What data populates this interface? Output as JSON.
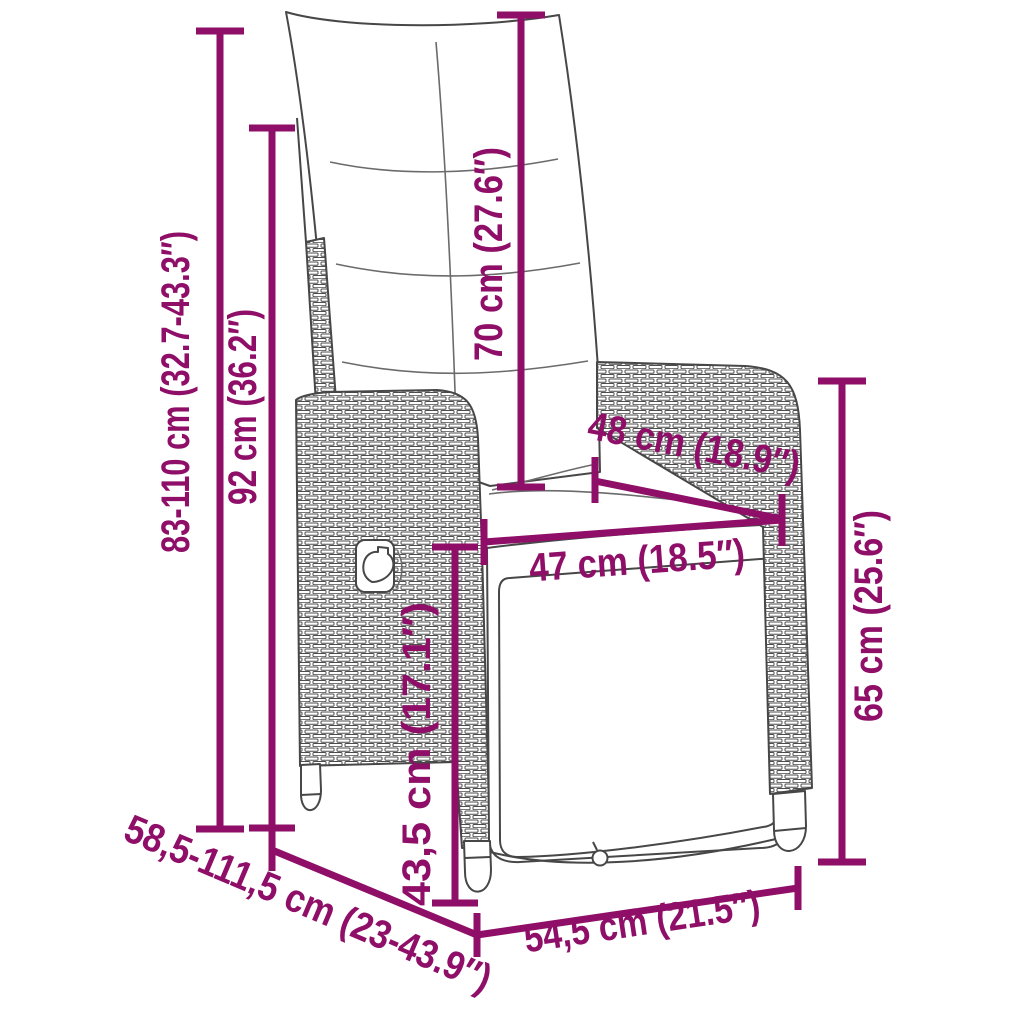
{
  "diagram": {
    "subject": "reclining garden chair with cushions - dimension drawing",
    "accent_color": "#8e0e68",
    "outline_color": "#474747",
    "units": [
      "cm",
      "inch"
    ],
    "dimensions": [
      {
        "id": "overall-height",
        "label": "83-110 cm (32.7-43.3″)",
        "orientation": "vertical"
      },
      {
        "id": "backrest-height",
        "label": "92 cm (36.2″)",
        "orientation": "vertical"
      },
      {
        "id": "back-cushion-height",
        "label": "70 cm (27.6″)",
        "orientation": "vertical"
      },
      {
        "id": "backrest-width",
        "label": "48 cm (18.9″)",
        "orientation": "diagonal"
      },
      {
        "id": "seat-width",
        "label": "47 cm (18.5″)",
        "orientation": "horizontal"
      },
      {
        "id": "armrest-height",
        "label": "65 cm (25.6″)",
        "orientation": "vertical"
      },
      {
        "id": "seat-height",
        "label": "43,5 cm (17.1″)",
        "orientation": "vertical"
      },
      {
        "id": "depth-range",
        "label": "58,5-111,5 cm (23-43.9″)",
        "orientation": "diagonal"
      },
      {
        "id": "base-depth",
        "label": "54,5 cm (21.5″)",
        "orientation": "diagonal"
      }
    ]
  }
}
